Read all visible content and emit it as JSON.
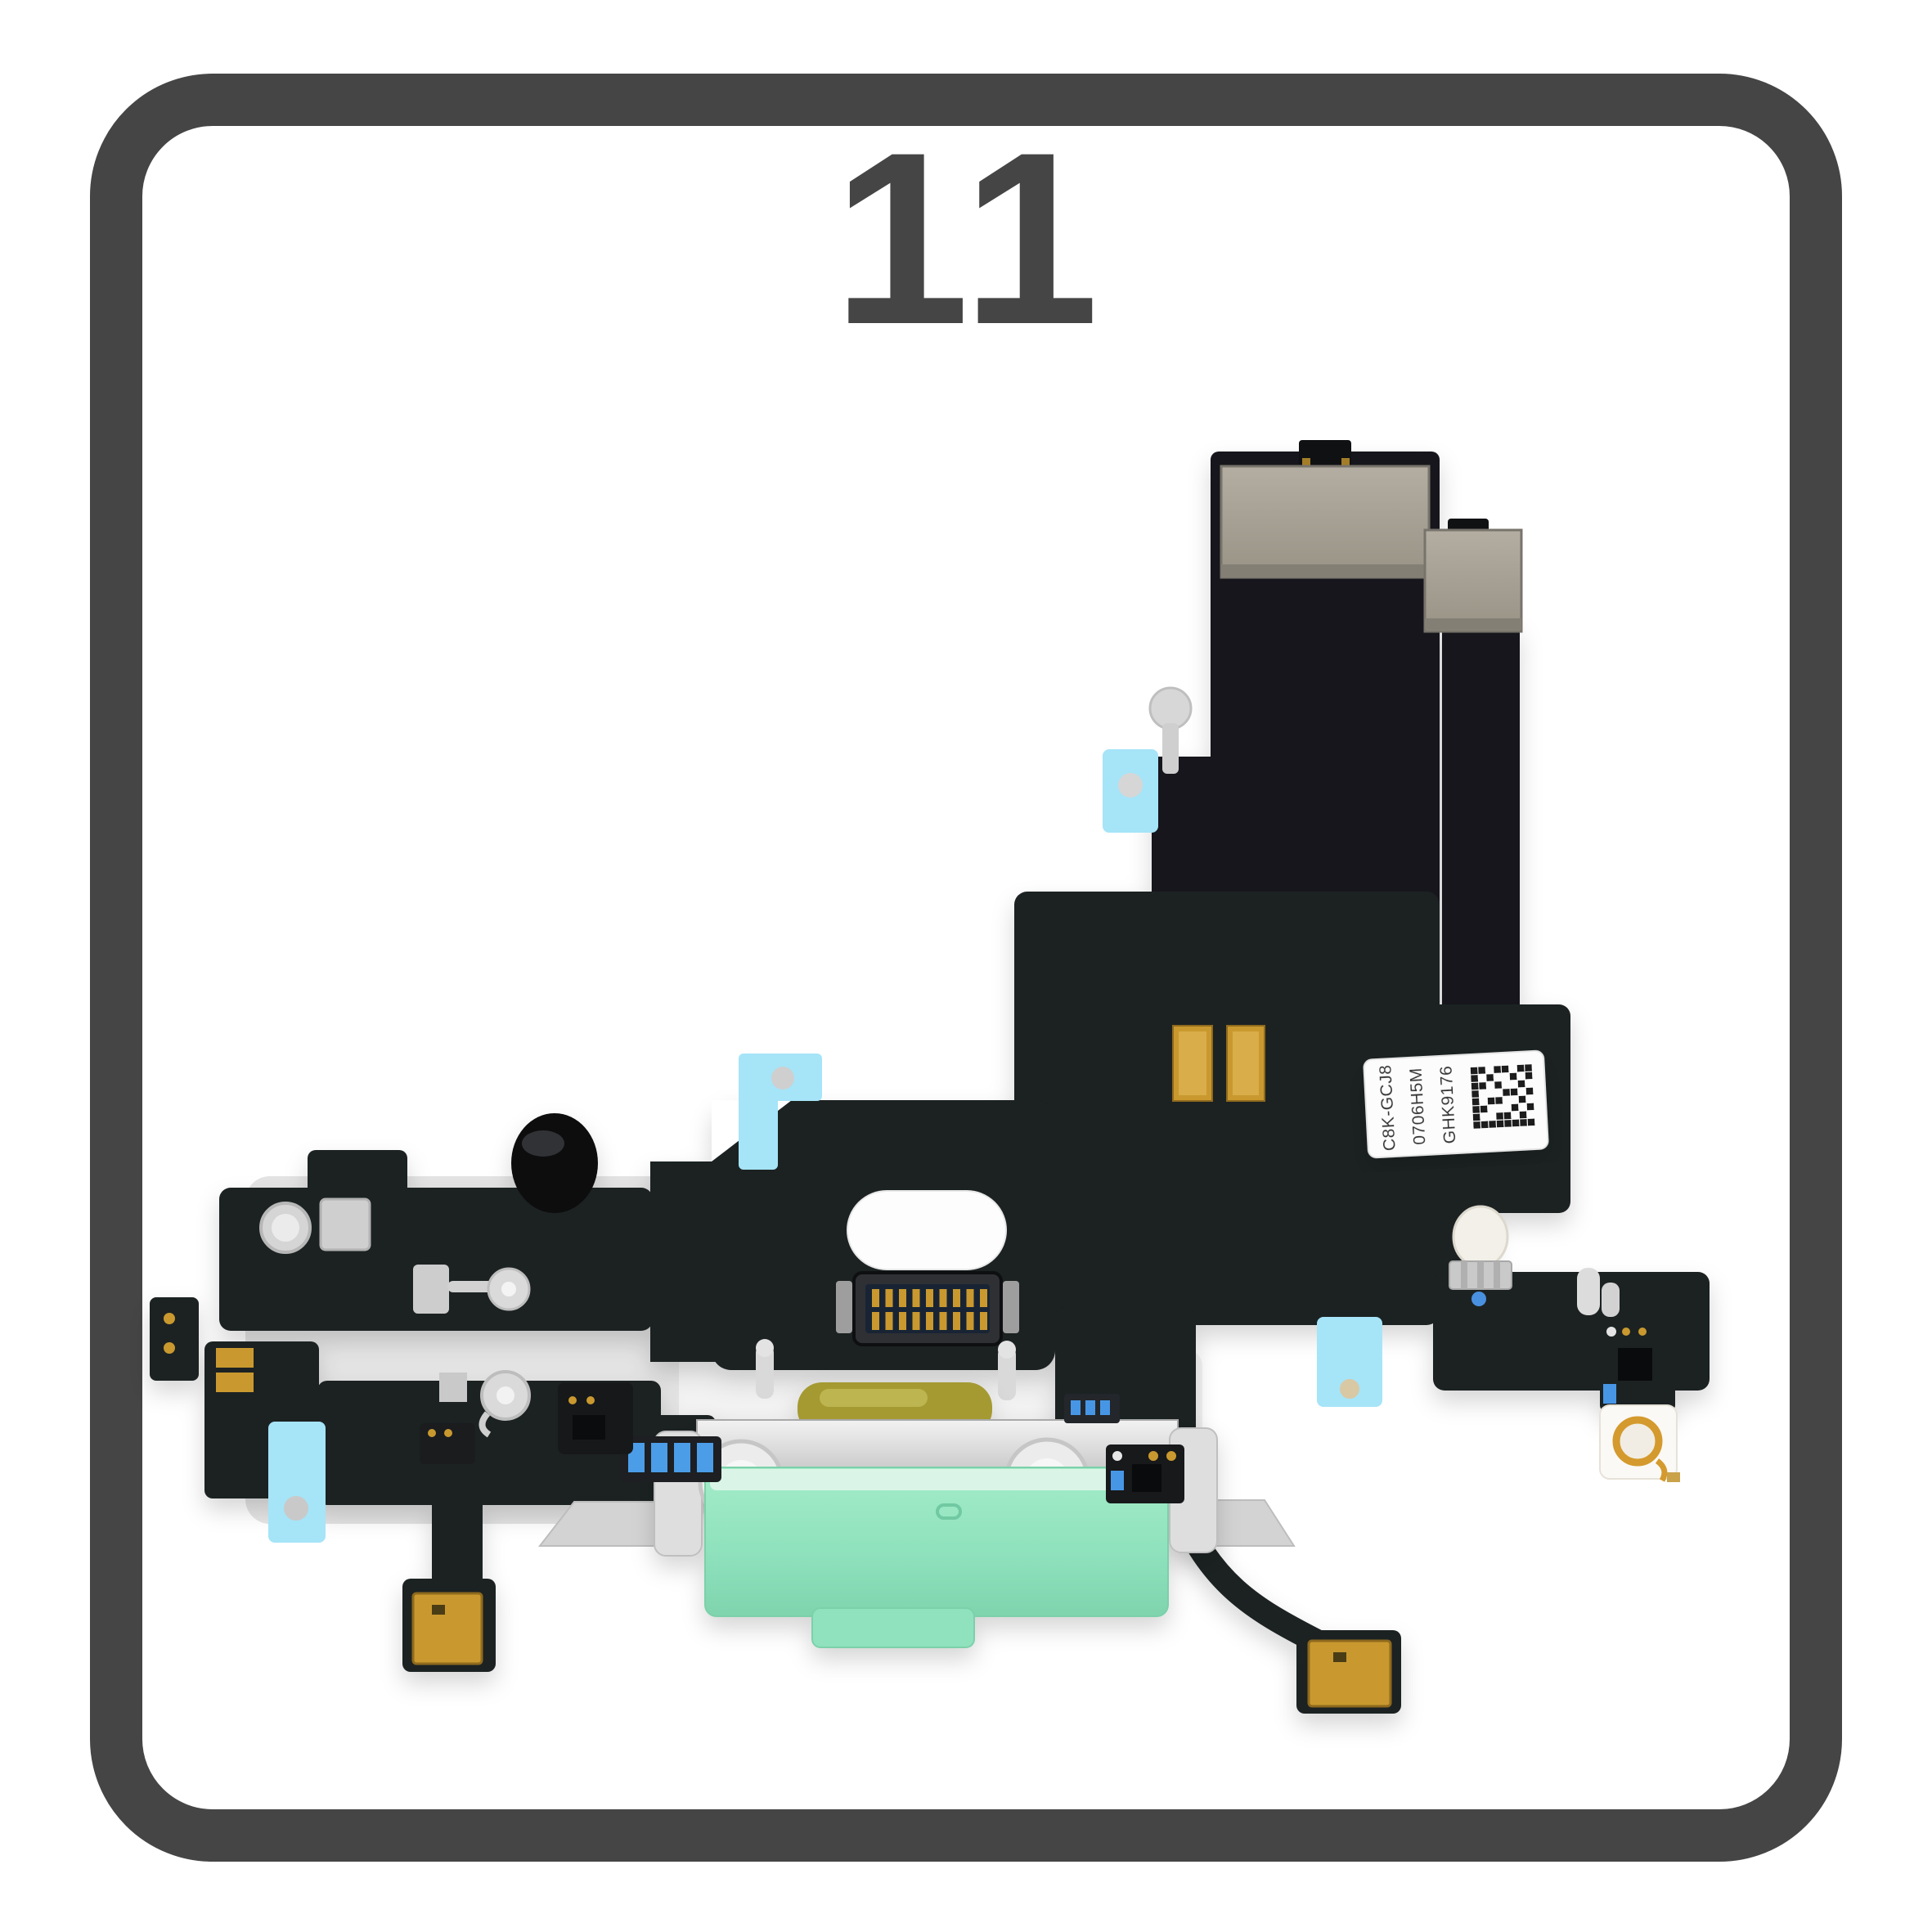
{
  "title": "11",
  "label": {
    "lines": [
      "C8K-GCJ8",
      "0706H5M",
      "GHK9176"
    ]
  },
  "colors": {
    "background": "#ffffff",
    "frame": "#454545",
    "title_color": "#454545",
    "flex_black": "#1e2023",
    "flex_black_dark": "#17181b",
    "stiffener": "#a69f94",
    "adhesive_blue": "#a6e4f8",
    "connector_green": "#8fe2bd",
    "connector_green_light": "#ddf5e9",
    "metal_silver": "#d9d9d9",
    "gold": "#c9992f",
    "olive": "#a59a33"
  }
}
